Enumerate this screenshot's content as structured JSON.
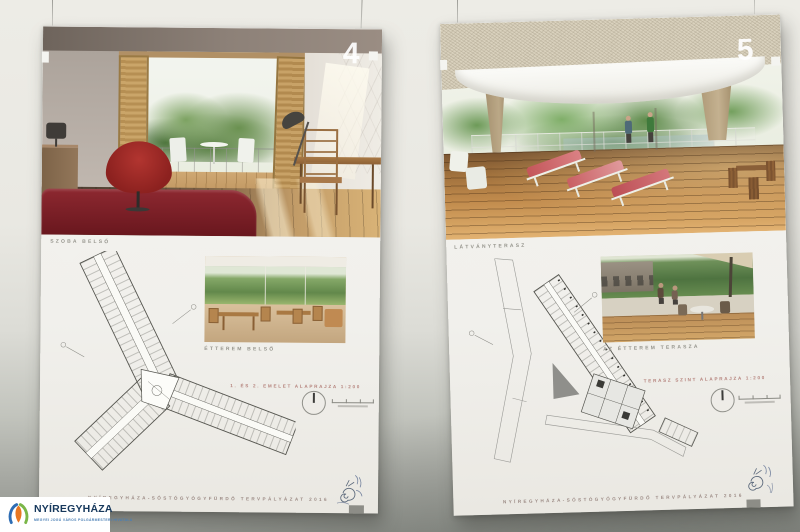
{
  "logo": {
    "name": "NYÍREGYHÁZA",
    "tagline": "MEGYEI JOGÚ VÁROS POLGÁRMESTERI HIVATALA",
    "colors": {
      "text": "#16385c",
      "tagline": "#4a7fb5",
      "petal_blue": "#2e6db4",
      "petal_green": "#7ab648",
      "petal_center": "#e87722"
    }
  },
  "boards": [
    {
      "number": "4",
      "main_caption": "SZOBA BELSŐ",
      "inset_caption": "ÉTTEREM BELSŐ",
      "plan_caption": "1. ÉS 2. EMELET ALAPRAJZA   1:200",
      "footer": "NYÍREGYHÁZA-SÓSTÓGYÓGYFÜRDŐ TERVPÁLYÁZAT 2016"
    },
    {
      "number": "5",
      "main_caption": "LÁTVÁNYTERASZ",
      "inset_caption": "AZ ÉTTEREM TERASZA",
      "plan_caption": "TERASZ SZINT ALAPRAJZA   1:200",
      "footer": "NYÍREGYHÁZA-SÓSTÓGYÓGYFÜRDŐ TERVPÁLYÁZAT 2016"
    }
  ],
  "palette": {
    "wall_top": "#edece6",
    "wall_bottom": "#90938d",
    "board_paper": "#f2f1ed",
    "photo_caption": "#95948c",
    "plan_caption": "#b5837c",
    "footer_text": "#9c8b85",
    "bed_red": "#7e2028",
    "chair_red": "#a82c28",
    "wood_light": "#caa569",
    "wood_floor": "#5d4b3a",
    "deck_wood": "#c08a4c",
    "tree_green": "#6a9150",
    "canopy_white": "#f6f6f1"
  }
}
